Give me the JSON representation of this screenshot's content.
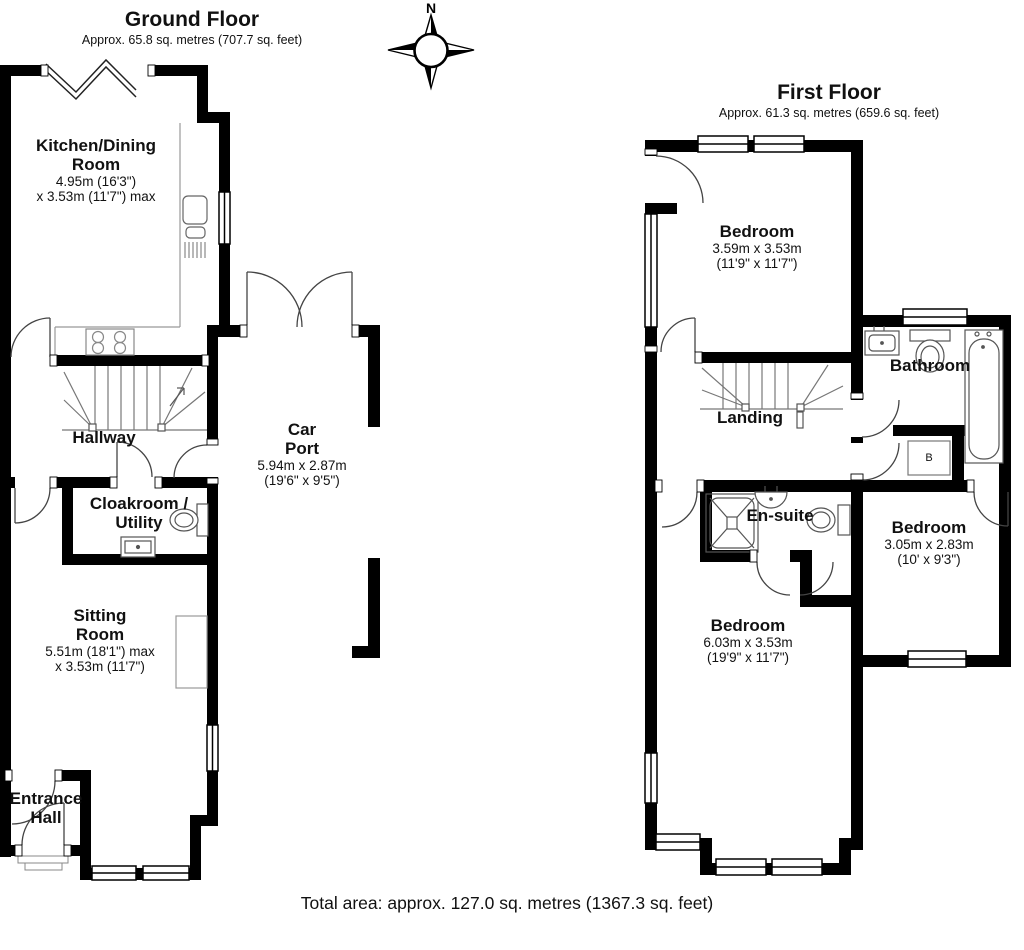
{
  "page": {
    "background": "#ffffff",
    "wall_color": "#000000"
  },
  "compass": {
    "north_label": "N"
  },
  "ground_floor": {
    "title": "Ground Floor",
    "subtitle": "Approx. 65.8 sq. metres (707.7 sq. feet)",
    "rooms": {
      "kitchen": {
        "name_line1": "Kitchen/Dining",
        "name_line2": "Room",
        "dims_line1": "4.95m (16'3\")",
        "dims_line2": "x 3.53m (11'7\") max"
      },
      "hallway": {
        "name": "Hallway"
      },
      "cloakroom": {
        "name_line1": "Cloakroom /",
        "name_line2": "Utility"
      },
      "sitting_room": {
        "name_line1": "Sitting",
        "name_line2": "Room",
        "dims_line1": "5.51m (18'1\") max",
        "dims_line2": "x 3.53m (11'7\")"
      },
      "entrance_hall": {
        "name_line1": "Entrance",
        "name_line2": "Hall"
      },
      "car_port": {
        "name_line1": "Car",
        "name_line2": "Port",
        "dims_line1": "5.94m x 2.87m",
        "dims_line2": "(19'6\" x 9'5\")"
      }
    }
  },
  "first_floor": {
    "title": "First Floor",
    "subtitle": "Approx. 61.3 sq. metres (659.6 sq. feet)",
    "rooms": {
      "bedroom_front": {
        "name": "Bedroom",
        "dims_line1": "3.59m x 3.53m",
        "dims_line2": "(11'9\" x 11'7\")"
      },
      "landing": {
        "name": "Landing"
      },
      "bathroom": {
        "name": "Bathroom"
      },
      "boiler": {
        "label": "B"
      },
      "en_suite": {
        "name": "En-suite"
      },
      "bedroom_right": {
        "name": "Bedroom",
        "dims_line1": "3.05m x 2.83m",
        "dims_line2": "(10' x 9'3\")"
      },
      "bedroom_rear": {
        "name": "Bedroom",
        "dims_line1": "6.03m x 3.53m",
        "dims_line2": "(19'9\" x 11'7\")"
      }
    }
  },
  "footer": {
    "total_area": "Total area: approx. 127.0 sq. metres (1367.3 sq. feet)"
  }
}
